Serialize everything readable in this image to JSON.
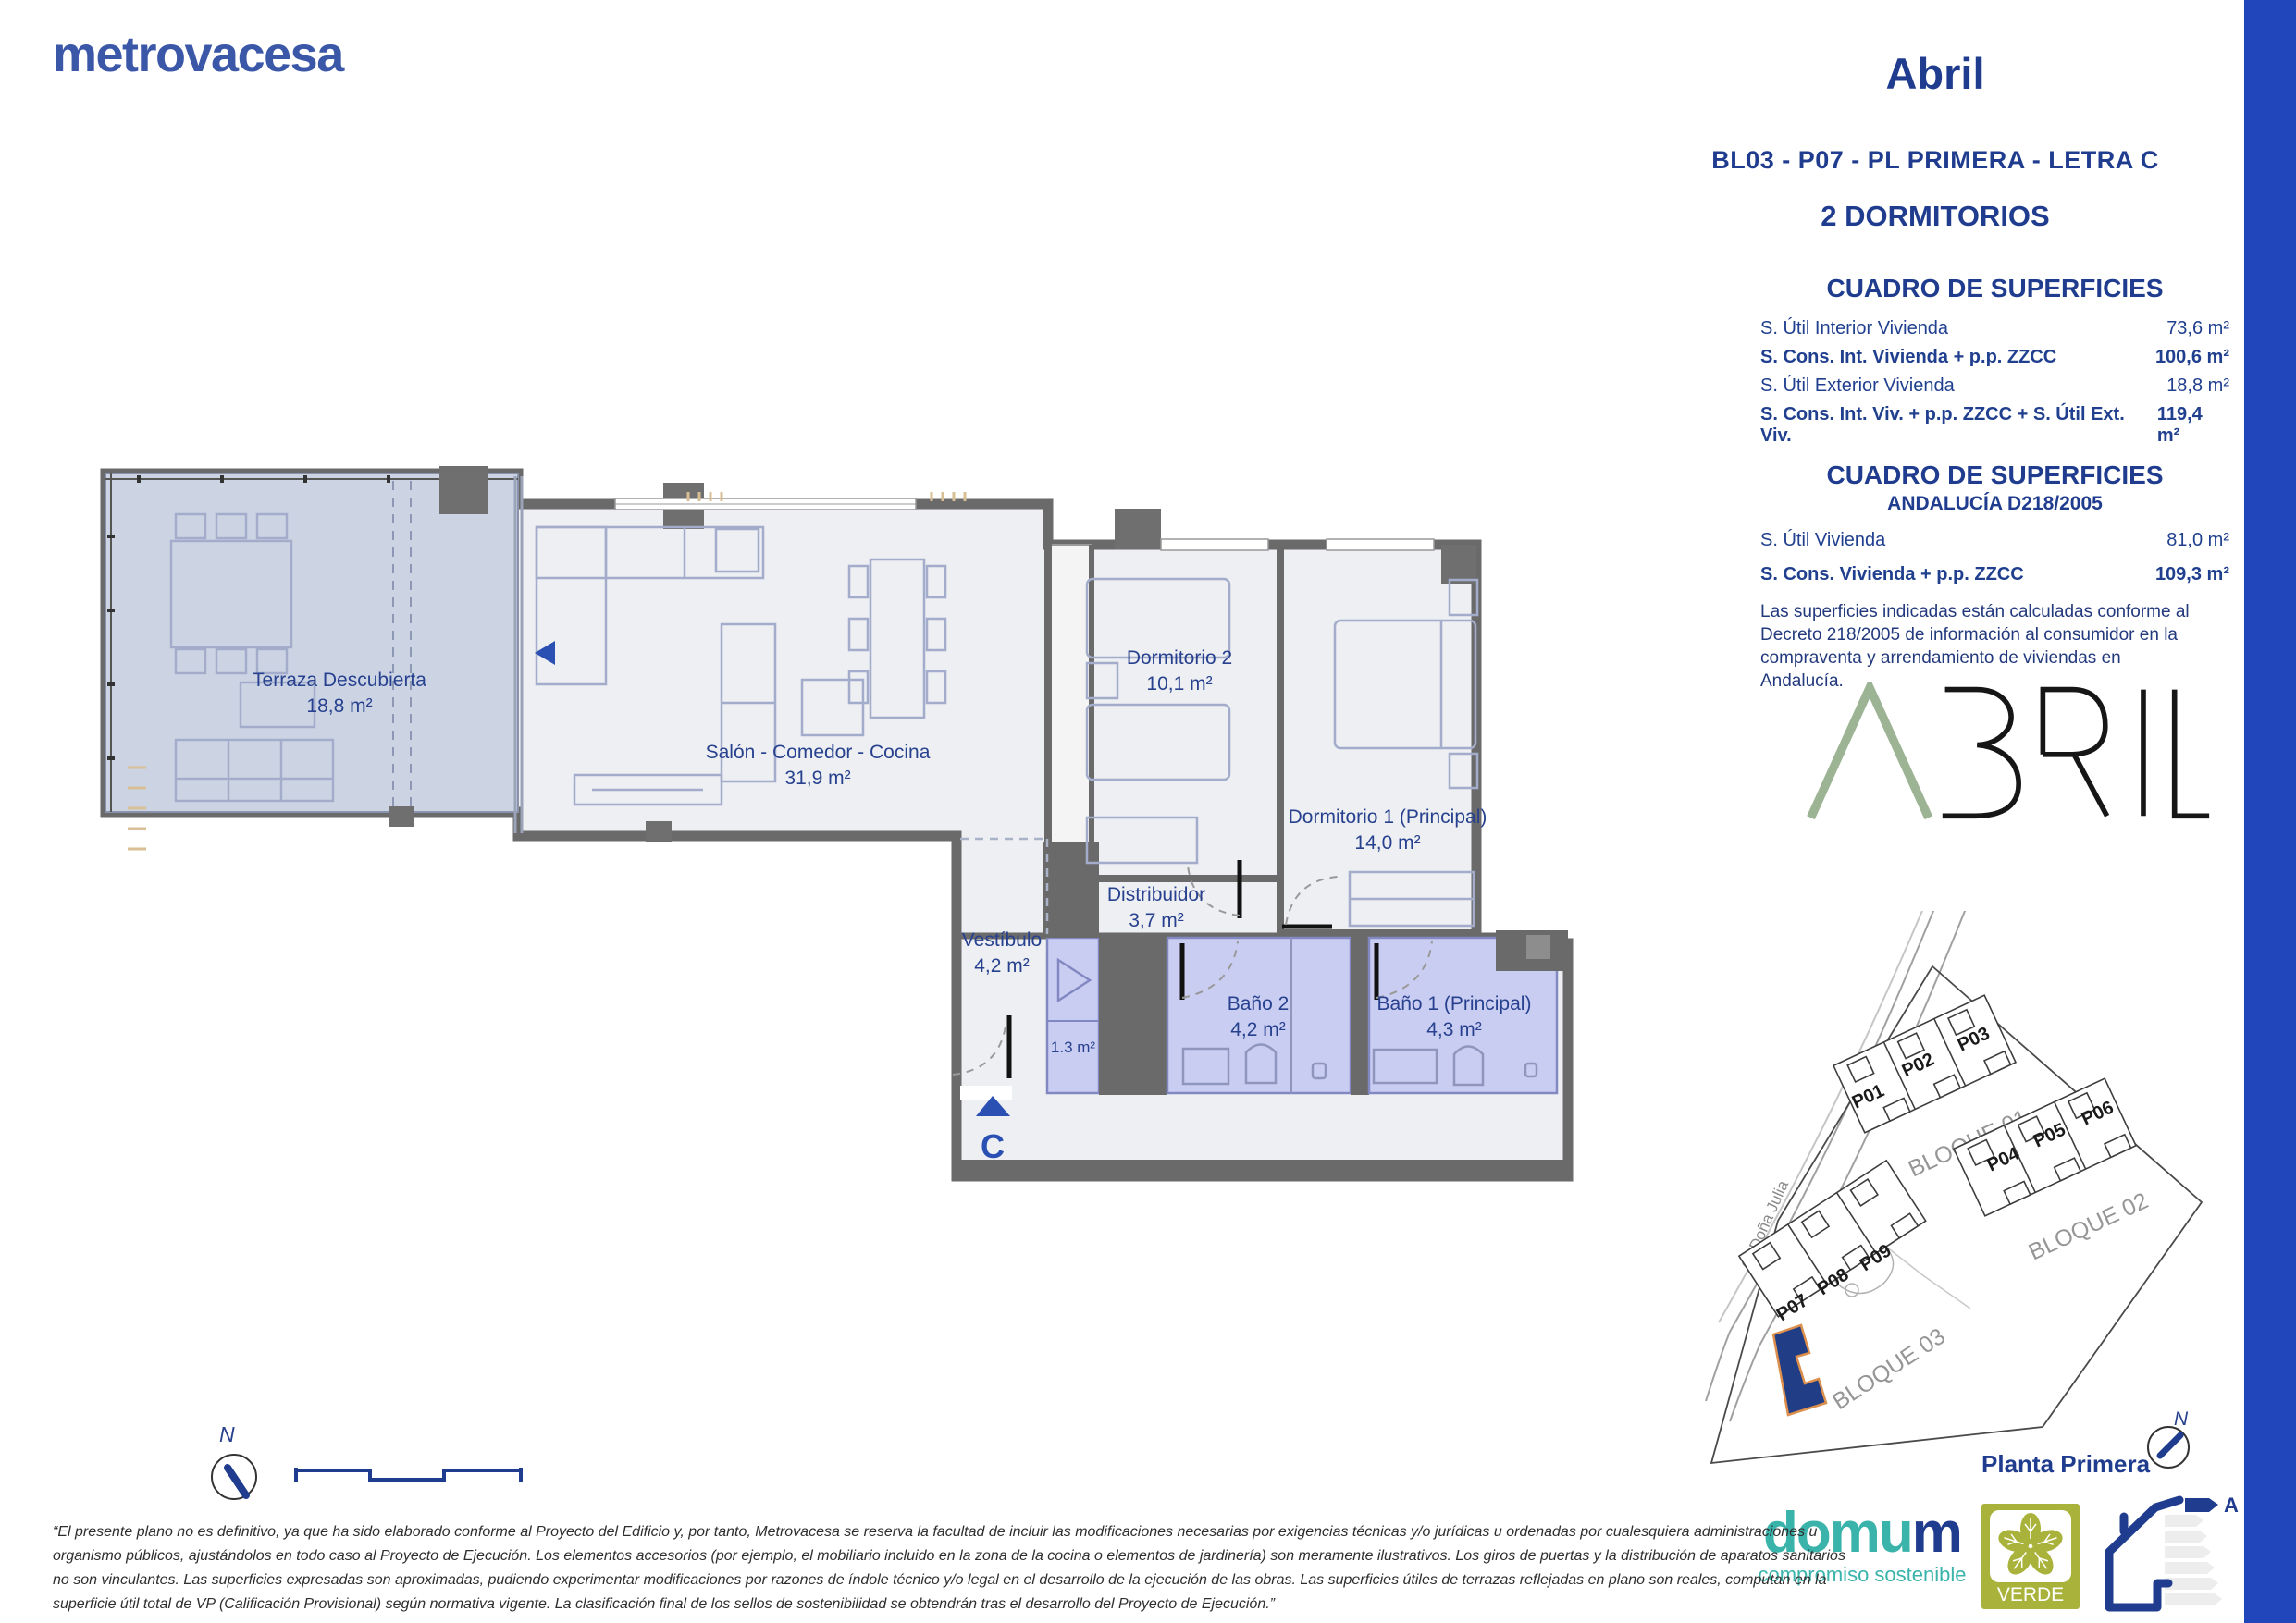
{
  "page": {
    "accent_bar_color": "#2146bb",
    "brand_color": "#3b57a8"
  },
  "brand": {
    "logo": "metrovacesa"
  },
  "header": {
    "title": "Abril",
    "subtitle": "BL03 - P07 - PL PRIMERA - LETRA C",
    "type_label": "2 DORMITORIOS"
  },
  "surfaces": {
    "title": "CUADRO DE SUPERFICIES",
    "rows": [
      {
        "label": "S. Útil Interior Vivienda",
        "value": "73,6 m²"
      },
      {
        "label": "S. Cons. Int. Vivienda + p.p. ZZCC",
        "value": "100,6 m²"
      },
      {
        "label": "S. Útil Exterior Vivienda",
        "value": "18,8 m²"
      },
      {
        "label": "S. Cons. Int. Viv. + p.p. ZZCC + S. Útil Ext. Viv.",
        "value": "119,4 m²"
      }
    ]
  },
  "surfaces_andalucia": {
    "title": "CUADRO DE SUPERFICIES",
    "subtitle": "ANDALUCÍA D218/2005",
    "rows": [
      {
        "label": "S. Útil Vivienda",
        "value": "81,0 m²"
      },
      {
        "label": "S. Cons. Vivienda + p.p. ZZCC",
        "value": "109,3 m²"
      }
    ],
    "note": "Las superficies indicadas están calculadas conforme al Decreto 218/2005 de información al consumidor en la compraventa y arrendamiento de viviendas en Andalucía."
  },
  "project_logo": {
    "text": "ABRIL"
  },
  "floor_plan": {
    "rooms": {
      "terraza": {
        "name": "Terraza Descubierta",
        "area": "18,8 m²"
      },
      "salon": {
        "name": "Salón - Comedor - Cocina",
        "area": "31,9 m²"
      },
      "dormitorio2": {
        "name": "Dormitorio 2",
        "area": "10,1 m²"
      },
      "dormitorio1": {
        "name": "Dormitorio 1 (Principal)",
        "area": "14,0 m²"
      },
      "distribuidor": {
        "name": "Distribuidor",
        "area": "3,7 m²"
      },
      "vestibulo": {
        "name": "Vestíbulo",
        "area": "4,2 m²"
      },
      "closet": {
        "area": "1.3 m²"
      },
      "bano2": {
        "name": "Baño 2",
        "area": "4,2 m²"
      },
      "bano1": {
        "name": "Baño 1 (Principal)",
        "area": "4,3 m²"
      }
    },
    "entrance_letter": "C",
    "north_label": "N"
  },
  "site_plan": {
    "street": "C/ Doña Julia",
    "blocks": [
      "BLOQUE 01",
      "BLOQUE 02",
      "BLOQUE 03"
    ],
    "plots": [
      "P01",
      "P02",
      "P03",
      "P04",
      "P05",
      "P06",
      "P07",
      "P08",
      "P09"
    ],
    "north_label": "N",
    "floor_label": "Planta Primera"
  },
  "footer": {
    "domum_part1": "domu",
    "domum_part2": "m",
    "domum_tagline": "compromiso sostenible",
    "verde_label": "VERDE",
    "energy_rating": "A",
    "disclaimer_lines": [
      "“El presente plano no es definitivo, ya que ha sido elaborado conforme al Proyecto del Edificio y, por tanto, Metrovacesa se reserva la facultad de incluir las modificaciones necesarias por exigencias técnicas y/o jurídicas u ordenadas por cualesquiera administraciones u",
      "organismo públicos, ajustándolos en todo caso al Proyecto de Ejecución. Los elementos accesorios (por ejemplo, el mobiliario incluido en la zona de la cocina o elementos de jardinería) son meramente ilustrativos. Los giros de puertas y la distribución de aparatos sanitarios",
      "no son vinculantes. Las superficies expresadas son aproximadas, pudiendo experimentar modificaciones por razones de índole técnico y/o legal en el desarrollo de la ejecución de las obras. Las superficies útiles de terrazas reflejadas en plano son reales, computan en la",
      "superficie útil total de VP (Calificación Provisional) según normativa vigente. La clasificación final de los sellos de sostenibilidad se obtendrán tras el desarrollo del Proyecto de Ejecución.”"
    ]
  }
}
